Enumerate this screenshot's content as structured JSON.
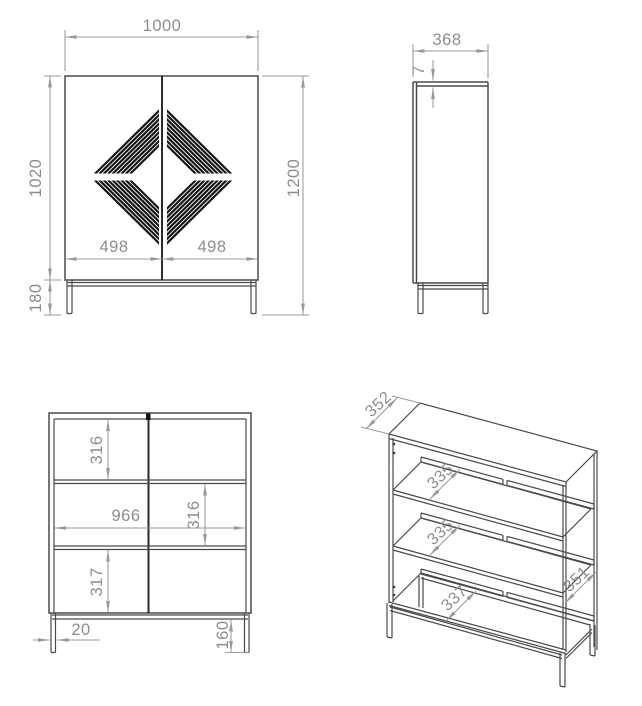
{
  "drawing": {
    "views": {
      "front": {
        "width": "1000",
        "body_height": "1020",
        "total_height": "1200",
        "door_left_width": "498",
        "door_right_width": "498",
        "leg_height": "180"
      },
      "side": {
        "depth": "368",
        "top_panel_thickness": "7"
      },
      "internal_front": {
        "top_compartment_height": "316",
        "inner_width": "966",
        "middle_compartment_height": "316",
        "bottom_compartment_height": "317",
        "leg_width": "20",
        "leg_clearance_height": "160"
      },
      "perspective": {
        "top_depth": "352",
        "upper_shelf_depth": "335",
        "middle_shelf_depth": "335",
        "lower_shelf_depth": "337",
        "side_depth": "351"
      }
    },
    "colors": {
      "outline": "#4a4a4a",
      "dimension": "#9a9a9a",
      "text": "#8d8d8d",
      "accent_black": "#141414",
      "background": "#ffffff"
    }
  }
}
